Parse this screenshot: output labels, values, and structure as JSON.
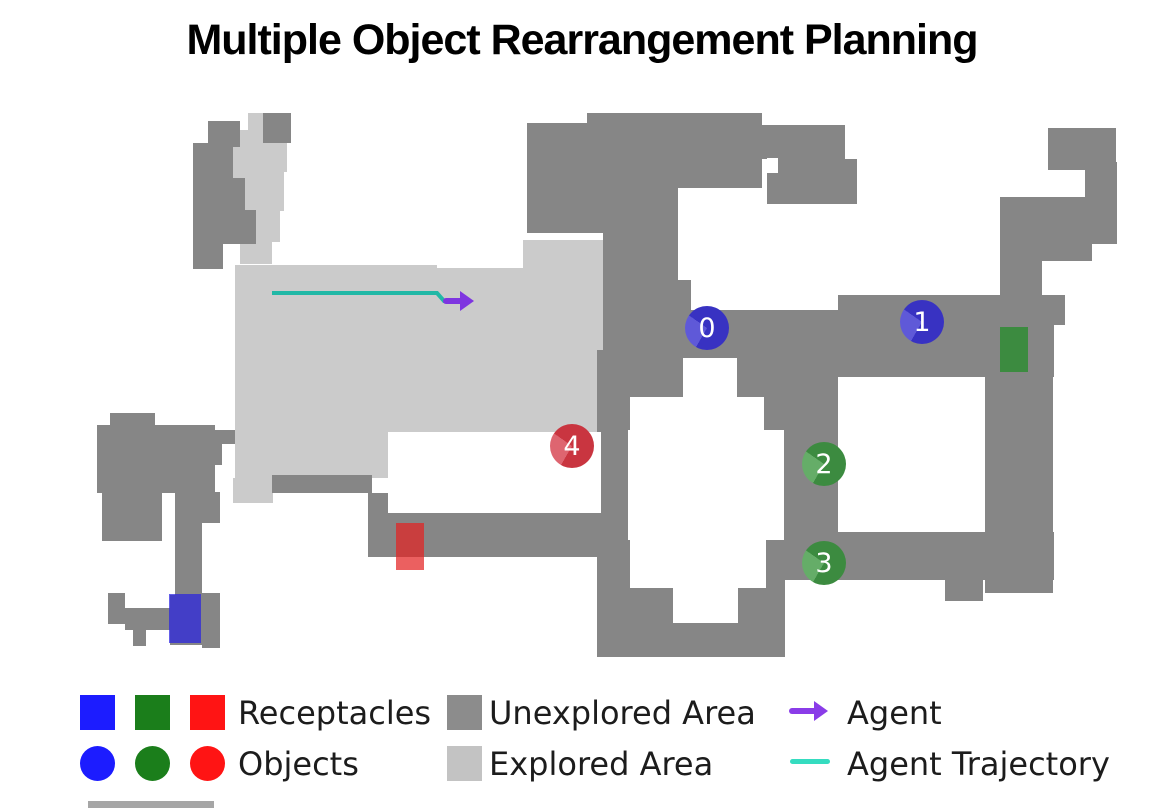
{
  "title": "Multiple Object Rearrangement Planning",
  "map": {
    "unexplored_color": "#868686",
    "explored_color": "#cbcbcb",
    "background": "#ffffff",
    "unexplored": [
      [
        263,
        113,
        28,
        30
      ],
      [
        208,
        121,
        32,
        26
      ],
      [
        193,
        143,
        40,
        38
      ],
      [
        193,
        178,
        52,
        34
      ],
      [
        193,
        210,
        63,
        34
      ],
      [
        193,
        242,
        30,
        27
      ],
      [
        527,
        123,
        76,
        110
      ],
      [
        587,
        113,
        175,
        75
      ],
      [
        762,
        125,
        83,
        34
      ],
      [
        767,
        159,
        90,
        45
      ],
      [
        603,
        188,
        75,
        152
      ],
      [
        603,
        280,
        88,
        72
      ],
      [
        635,
        310,
        205,
        52
      ],
      [
        838,
        295,
        216,
        82
      ],
      [
        1048,
        128,
        68,
        42
      ],
      [
        1085,
        162,
        32,
        38
      ],
      [
        1000,
        197,
        117,
        47
      ],
      [
        1042,
        244,
        50,
        17
      ],
      [
        1000,
        244,
        42,
        62
      ],
      [
        1053,
        295,
        12,
        30
      ],
      [
        985,
        377,
        68,
        216
      ],
      [
        783,
        360,
        57,
        174
      ],
      [
        783,
        532,
        271,
        48
      ],
      [
        945,
        580,
        38,
        21
      ],
      [
        597,
        350,
        188,
        307
      ],
      [
        368,
        493,
        232,
        64
      ],
      [
        272,
        475,
        100,
        18
      ],
      [
        110,
        413,
        45,
        22
      ],
      [
        97,
        425,
        118,
        68
      ],
      [
        102,
        493,
        60,
        48
      ],
      [
        178,
        430,
        57,
        14
      ],
      [
        190,
        443,
        32,
        22
      ],
      [
        175,
        492,
        27,
        106
      ],
      [
        202,
        492,
        18,
        31
      ],
      [
        202,
        593,
        18,
        55
      ],
      [
        170,
        595,
        32,
        50
      ],
      [
        108,
        593,
        17,
        31
      ],
      [
        125,
        608,
        50,
        22
      ],
      [
        133,
        630,
        13,
        16
      ]
    ],
    "explored": [
      [
        248,
        113,
        34,
        30
      ],
      [
        233,
        130,
        54,
        42
      ],
      [
        222,
        165,
        62,
        46
      ],
      [
        230,
        208,
        50,
        34
      ],
      [
        240,
        240,
        32,
        24
      ],
      [
        235,
        265,
        202,
        213
      ],
      [
        437,
        268,
        86,
        210
      ],
      [
        523,
        240,
        112,
        238
      ],
      [
        233,
        478,
        40,
        25
      ]
    ],
    "cutouts": [
      [
        388,
        432,
        213,
        81
      ],
      [
        838,
        377,
        147,
        155
      ],
      [
        683,
        358,
        54,
        40
      ],
      [
        630,
        397,
        134,
        34
      ],
      [
        628,
        430,
        156,
        110
      ],
      [
        630,
        540,
        136,
        48
      ],
      [
        673,
        588,
        65,
        35
      ],
      [
        767,
        158,
        11,
        15
      ]
    ],
    "receptacles": [
      {
        "name": "blue-receptacle",
        "color": "#2a22e0",
        "x": 169,
        "y": 594,
        "w": 32,
        "h": 49,
        "alpha": 0.72
      },
      {
        "name": "green-receptacle",
        "color": "#3c8b40",
        "x": 1000,
        "y": 327,
        "w": 28,
        "h": 45,
        "alpha": 1
      },
      {
        "name": "red-receptacle",
        "color": "#e32222",
        "x": 396,
        "y": 523,
        "w": 28,
        "h": 47,
        "alpha": 0.72
      }
    ],
    "objects": [
      {
        "label": "0",
        "x": 707,
        "y": 328,
        "r": 22,
        "color": "blue"
      },
      {
        "label": "1",
        "x": 922,
        "y": 322,
        "r": 22,
        "color": "blue"
      },
      {
        "label": "2",
        "x": 824,
        "y": 464,
        "r": 22,
        "color": "green"
      },
      {
        "label": "3",
        "x": 824,
        "y": 563,
        "r": 22,
        "color": "green"
      },
      {
        "label": "4",
        "x": 572,
        "y": 446,
        "r": 22,
        "color": "red"
      }
    ],
    "palettes": {
      "blue": {
        "base": "#3832c2",
        "light": "#5f59d8"
      },
      "green": {
        "base": "#3c8b40",
        "light": "#65ad68"
      },
      "red": {
        "base": "#c93540",
        "light": "#de6570"
      }
    },
    "trajectory": {
      "color": "#21b8a6",
      "points": [
        [
          272,
          293
        ],
        [
          437,
          293
        ],
        [
          444,
          301
        ],
        [
          450,
          301
        ]
      ],
      "arrow": {
        "color": "#7e35e0",
        "from": [
          446,
          301
        ],
        "to": [
          460,
          301
        ]
      }
    }
  },
  "legend": {
    "receptacles": {
      "label": "Receptacles",
      "colors": [
        "#1c1cff",
        "#1b7e1b",
        "#ff1414"
      ]
    },
    "objects": {
      "label": "Objects",
      "colors": [
        "#1c1cff",
        "#1b7e1b",
        "#ff1414"
      ]
    },
    "unexplored": {
      "label": "Unexplored Area",
      "color": "#8c8c8c"
    },
    "explored": {
      "label": "Explored Area",
      "color": "#c3c3c3"
    },
    "agent": {
      "label": "Agent",
      "color": "#8a3ce8"
    },
    "trajectory": {
      "label": "Agent Trajectory",
      "color": "#35dcc0"
    }
  },
  "scrap_bar_color": "#a6a6a6"
}
